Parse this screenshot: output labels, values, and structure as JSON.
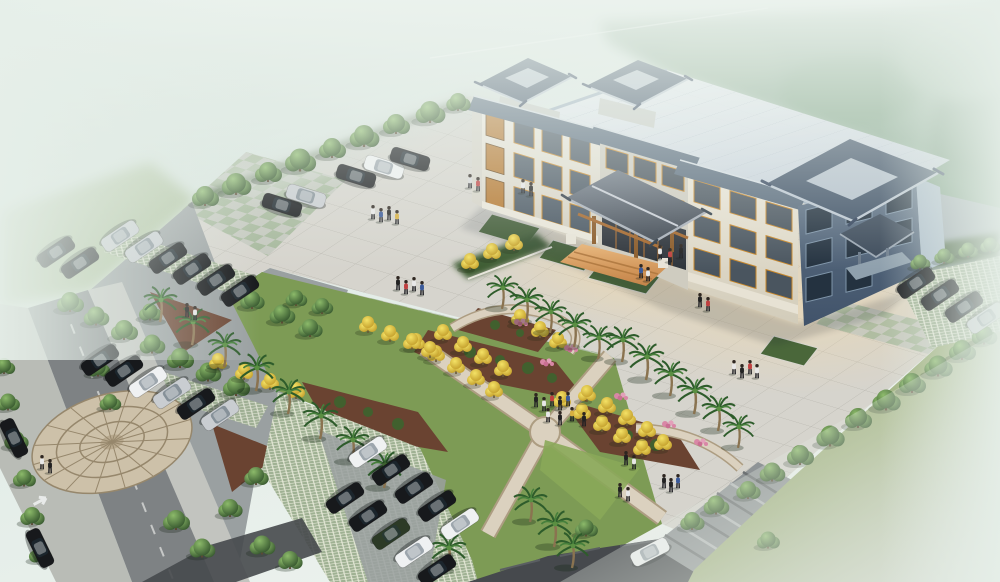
{
  "meta": {
    "title": "aerial-architectural-rendering",
    "type": "3d-exterior-rendering",
    "description": "Bird's-eye rendering of a Chinese-style civic office building with large paved plaza, landscaped gardens with crossing walkways, palm and ginkgo trees, three car parks and perimeter roads fading into mist",
    "width": 1000,
    "height": 582
  },
  "scene": {
    "palette": {
      "mist": "#e8f0eb",
      "sky": "#c9dad1",
      "forest": "#87a78e",
      "lawn": "#8da863",
      "lawn_mist": "#bcc6b2",
      "plaza": "#d6d4cd",
      "plaza_shadow": "#9aa5ab",
      "asphalt": "#9aa0a1",
      "road": "#7e8284",
      "road_dark": "#46494d",
      "lattice": "#9fb193",
      "mulch": "#6a4331",
      "path": "#dbd1bf",
      "checker_green": "#a4b799",
      "checker_gray": "#c3c7bd",
      "roof_light": "#e2e8ee",
      "roof_tile": "#3f5166",
      "wall_light": "#ece8db",
      "wall_dark": "#55687c",
      "wood": "#b5712f",
      "entrance_floor": "#dd9f5e",
      "inset_green": "#4a673a",
      "yellow_tree": "#e6c938",
      "flower_pink": "#d987a6",
      "car_black": "#17191c",
      "car_silver": "#c9cdd1",
      "car_white": "#eff1f2",
      "car_green": "#2c3a26"
    },
    "objects": {
      "trees": [
        [
          205,
          196,
          1.0
        ],
        [
          236,
          184,
          1.1
        ],
        [
          268,
          172,
          1.0
        ],
        [
          300,
          160,
          1.15
        ],
        [
          332,
          148,
          1.0
        ],
        [
          364,
          136,
          1.1
        ],
        [
          396,
          124,
          1.0
        ],
        [
          430,
          112,
          1.1
        ],
        [
          458,
          102,
          0.9
        ],
        [
          70,
          302,
          1.0
        ],
        [
          96,
          316,
          0.95
        ],
        [
          124,
          330,
          1.0
        ],
        [
          152,
          344,
          0.95
        ],
        [
          180,
          358,
          1.0
        ],
        [
          208,
          372,
          0.95
        ],
        [
          236,
          386,
          1.0
        ],
        [
          252,
          300,
          0.9
        ],
        [
          282,
          314,
          0.95
        ],
        [
          310,
          328,
          0.9
        ],
        [
          150,
          312,
          0.85
        ],
        [
          176,
          520,
          1.0
        ],
        [
          202,
          548,
          0.95
        ],
        [
          230,
          508,
          0.9
        ],
        [
          256,
          476,
          0.9
        ],
        [
          262,
          545,
          0.95
        ],
        [
          290,
          560,
          0.9
        ],
        [
          8,
          402,
          0.85
        ],
        [
          16,
          440,
          0.9
        ],
        [
          24,
          478,
          0.85
        ],
        [
          32,
          516,
          0.9
        ],
        [
          40,
          554,
          0.85
        ],
        [
          4,
          366,
          0.8
        ],
        [
          98,
          368,
          0.85
        ],
        [
          110,
          402,
          0.8
        ],
        [
          800,
          455,
          1.0
        ],
        [
          830,
          436,
          1.05
        ],
        [
          858,
          418,
          1.0
        ],
        [
          886,
          400,
          1.05
        ],
        [
          912,
          383,
          1.0
        ],
        [
          938,
          366,
          1.05
        ],
        [
          962,
          350,
          1.0
        ],
        [
          984,
          335,
          0.95
        ],
        [
          772,
          472,
          0.95
        ],
        [
          748,
          490,
          0.9
        ],
        [
          716,
          505,
          0.95
        ],
        [
          692,
          521,
          0.9
        ],
        [
          768,
          540,
          0.85
        ],
        [
          586,
          528,
          0.85
        ],
        [
          920,
          262,
          0.75
        ],
        [
          944,
          256,
          0.75
        ],
        [
          968,
          250,
          0.75
        ],
        [
          990,
          245,
          0.75
        ],
        [
          296,
          298,
          0.8
        ],
        [
          322,
          306,
          0.8
        ]
      ],
      "palms": [
        [
          160,
          300,
          1.0
        ],
        [
          192,
          322,
          1.05
        ],
        [
          224,
          345,
          1.0
        ],
        [
          256,
          368,
          1.05
        ],
        [
          288,
          392,
          1.0
        ],
        [
          320,
          416,
          1.05
        ],
        [
          352,
          440,
          1.0
        ],
        [
          384,
          465,
          1.05
        ],
        [
          448,
          548,
          1.05
        ],
        [
          530,
          500,
          1.0
        ],
        [
          554,
          524,
          1.05
        ],
        [
          572,
          546,
          1.0
        ],
        [
          502,
          288,
          0.95
        ],
        [
          526,
          300,
          1.0
        ],
        [
          550,
          312,
          0.95
        ],
        [
          574,
          325,
          1.0
        ],
        [
          598,
          338,
          0.95
        ],
        [
          622,
          340,
          1.0
        ],
        [
          646,
          357,
          1.05
        ],
        [
          670,
          374,
          1.0
        ],
        [
          694,
          391,
          1.05
        ],
        [
          718,
          409,
          1.0
        ],
        [
          738,
          427,
          0.95
        ]
      ],
      "ytrees": [
        [
          416,
          342
        ],
        [
          436,
          354
        ],
        [
          456,
          366
        ],
        [
          476,
          378
        ],
        [
          494,
          390
        ],
        [
          443,
          333
        ],
        [
          463,
          345
        ],
        [
          483,
          357
        ],
        [
          503,
          369
        ],
        [
          520,
          318
        ],
        [
          540,
          330
        ],
        [
          558,
          341
        ],
        [
          562,
          400
        ],
        [
          582,
          412
        ],
        [
          602,
          424
        ],
        [
          622,
          436
        ],
        [
          642,
          448
        ],
        [
          587,
          394
        ],
        [
          607,
          406
        ],
        [
          627,
          418
        ],
        [
          647,
          430
        ],
        [
          663,
          443
        ],
        [
          368,
          325
        ],
        [
          390,
          334
        ],
        [
          412,
          342
        ],
        [
          430,
          350
        ],
        [
          218,
          362
        ],
        [
          244,
          372
        ],
        [
          270,
          382
        ],
        [
          296,
          391
        ],
        [
          470,
          262
        ],
        [
          492,
          252
        ],
        [
          514,
          243
        ]
      ],
      "flowers": [
        [
          520,
          322
        ],
        [
          546,
          362
        ],
        [
          620,
          396
        ],
        [
          668,
          424
        ],
        [
          700,
          442
        ],
        [
          570,
          348
        ]
      ],
      "cars": [
        [
          120,
          236,
          146,
          "silver"
        ],
        [
          144,
          247,
          146,
          "silver"
        ],
        [
          168,
          258,
          146,
          "black"
        ],
        [
          192,
          269,
          146,
          "black"
        ],
        [
          216,
          280,
          146,
          "black"
        ],
        [
          240,
          291,
          146,
          "black"
        ],
        [
          100,
          360,
          146,
          "black"
        ],
        [
          124,
          371,
          146,
          "black"
        ],
        [
          148,
          382,
          146,
          "white"
        ],
        [
          172,
          393,
          146,
          "silver"
        ],
        [
          196,
          404,
          146,
          "black"
        ],
        [
          220,
          415,
          146,
          "silver"
        ],
        [
          56,
          252,
          146,
          "black"
        ],
        [
          80,
          263,
          146,
          "black"
        ],
        [
          356,
          176,
          17,
          "black"
        ],
        [
          384,
          167,
          17,
          "white"
        ],
        [
          410,
          159,
          17,
          "black"
        ],
        [
          282,
          205,
          17,
          "black"
        ],
        [
          306,
          196,
          17,
          "silver"
        ],
        [
          368,
          452,
          146,
          "white"
        ],
        [
          391,
          470,
          146,
          "black"
        ],
        [
          414,
          488,
          146,
          "black"
        ],
        [
          437,
          506,
          146,
          "black"
        ],
        [
          460,
          524,
          146,
          "white"
        ],
        [
          345,
          498,
          146,
          "black"
        ],
        [
          368,
          516,
          146,
          "black"
        ],
        [
          391,
          534,
          146,
          "green"
        ],
        [
          414,
          552,
          146,
          "white"
        ],
        [
          437,
          570,
          146,
          "black"
        ],
        [
          916,
          283,
          146,
          "black"
        ],
        [
          940,
          295,
          146,
          "black"
        ],
        [
          964,
          307,
          146,
          "black"
        ],
        [
          986,
          318,
          146,
          "silver"
        ],
        [
          14,
          438,
          64,
          "black"
        ],
        [
          40,
          548,
          64,
          "black"
        ],
        [
          650,
          552,
          -27,
          "white"
        ]
      ],
      "people": [
        [
          470,
          181,
          "#d8d8d8"
        ],
        [
          478,
          184,
          "#c04040"
        ],
        [
          373,
          212,
          "#e8e8e8"
        ],
        [
          381,
          215,
          "#3a5a9a"
        ],
        [
          389,
          213,
          "#222222"
        ],
        [
          397,
          217,
          "#d8b040"
        ],
        [
          660,
          252,
          "#e8e8e8"
        ],
        [
          670,
          255,
          "#c04040"
        ],
        [
          681,
          251,
          "#222222"
        ],
        [
          641,
          271,
          "#3a5a9a"
        ],
        [
          648,
          274,
          "#e8e8e8"
        ],
        [
          398,
          283,
          "#222222"
        ],
        [
          406,
          287,
          "#c04040"
        ],
        [
          414,
          284,
          "#e8e8e8"
        ],
        [
          422,
          288,
          "#3a5a9a"
        ],
        [
          536,
          400,
          "#222222"
        ],
        [
          544,
          404,
          "#e8e8e8"
        ],
        [
          552,
          399,
          "#c04040"
        ],
        [
          560,
          403,
          "#222222"
        ],
        [
          568,
          399,
          "#3a5a9a"
        ],
        [
          548,
          415,
          "#e8e8e8"
        ],
        [
          560,
          418,
          "#222222"
        ],
        [
          572,
          414,
          "#d8b040"
        ],
        [
          584,
          419,
          "#222222"
        ],
        [
          626,
          458,
          "#222222"
        ],
        [
          634,
          462,
          "#e8e8e8"
        ],
        [
          664,
          481,
          "#222222"
        ],
        [
          671,
          485,
          "#222222"
        ],
        [
          678,
          481,
          "#3a5a9a"
        ],
        [
          734,
          367,
          "#e8e8e8"
        ],
        [
          742,
          371,
          "#222222"
        ],
        [
          750,
          367,
          "#c04040"
        ],
        [
          757,
          371,
          "#e8e8e8"
        ],
        [
          620,
          490,
          "#222222"
        ],
        [
          628,
          494,
          "#e8e8e8"
        ],
        [
          42,
          462,
          "#e8e8e8"
        ],
        [
          50,
          466,
          "#222222"
        ],
        [
          187,
          310,
          "#222222"
        ],
        [
          195,
          313,
          "#e8e8e8"
        ],
        [
          523,
          186,
          "#e8e8e8"
        ],
        [
          531,
          189,
          "#222222"
        ],
        [
          700,
          300,
          "#222222"
        ],
        [
          708,
          304,
          "#c04040"
        ]
      ]
    }
  }
}
